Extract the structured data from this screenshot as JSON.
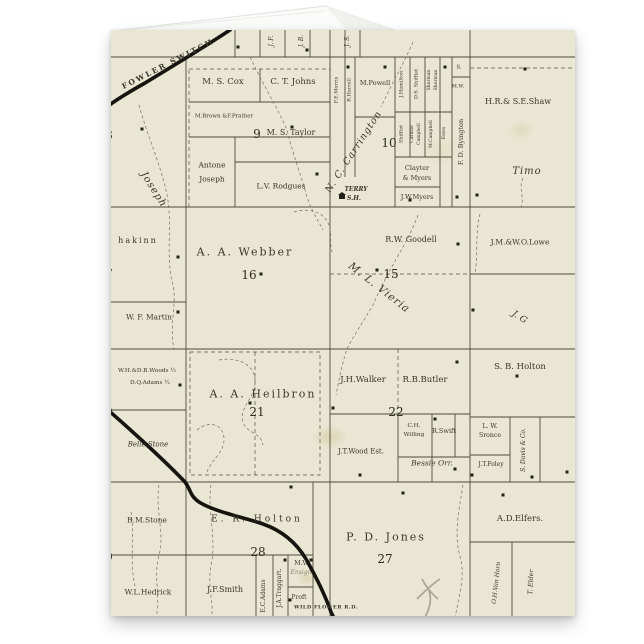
{
  "scene": {
    "background": "#ffffff",
    "paper_color": "#e9e6d3",
    "ink_color": "#3a362c",
    "railroad_color": "#15140f"
  },
  "map": {
    "railroad_label": "FOWLER SWITCH",
    "bottom_road_label": "WILD FLOWER R.D.",
    "school": {
      "line1": "TERRY",
      "line2": "S.H."
    },
    "top_strip": {
      "jf": "J. F.",
      "jb": "J. B.",
      "js": "J. S."
    },
    "section_numbers": {
      "n8": "8",
      "n9": "9",
      "n10": "10",
      "n15": "15",
      "n16": "16",
      "n17": "7",
      "n20": "0",
      "n21": "21",
      "n22": "22",
      "n27": "27",
      "n28": "28",
      "n29": "9"
    },
    "owners": {
      "joseph_diag": "Joseph",
      "cox": "M. S. Cox",
      "johns": "C. T. Johns",
      "brown_prather": "M.Brown &F.Prather",
      "taylor": "M. S. Taylor",
      "antone1": "Antone",
      "antone2": "Joseph",
      "rodgues": "L.V. Rodgues",
      "morris": "F.E.Morris",
      "harrell": "R.Harrell",
      "powell": "M.Powell",
      "hamilton": "J.Hamilton",
      "ds_shifflet": "D.S. Shifflet",
      "sherman1": "Sherman",
      "sherman2": "Sherman",
      "s_small": "S.",
      "mw_small": "M.W.",
      "shifflet": "Shifflet",
      "carlisle": "Carlisle",
      "campbell": "Campbell",
      "mccampbell": "M.Campbell",
      "estes": "Estes",
      "clayter1": "Clayter",
      "clayter2": "& Myers",
      "jw_myers": "J.W.Myers",
      "byington": "F. D. Byington",
      "carrington": "N. C. Carrington",
      "shaw": "H.R.& S.E.Shaw",
      "timo": "Timo",
      "hakinn": "hakinn",
      "martin": "W. F. Martin",
      "webber": "A. A. Webber",
      "goodell": "R.W. Goodell",
      "vieria": "M. L. Vieria",
      "lowe": "J.M.&W.O.Lowe",
      "jg": "J. G",
      "woods": "W.H.&D.B.Woods ½",
      "dq_adams": "D.Q.Adams ½",
      "belle_stone": "Belle Stone",
      "heilbron": "A. A. Heilbron",
      "walker": "J.H.Walker",
      "butler": "R.B.Butler",
      "willing1": "C.H.",
      "willing2": "Willing",
      "swift": "R.Swift",
      "wood_est": "J.T.Wood Est.",
      "bessie_orr": "Bessie Orr.",
      "sb_holton": "S. B. Holton",
      "sronce1": "L. W.",
      "sronce2": "Sronce",
      "davis": "S. Davis & Co.",
      "foley": "J.T.Foley",
      "bm_stone": "B.M.Stone",
      "hedrick": "W.L.Hedrick",
      "er_holton": "E. R. Holton",
      "smith": "J.F.Smith",
      "ec_adams": "E.C.Adams",
      "traggart": "J.A.Traggart.",
      "mv1": "M.V.",
      "mv2": "Ensign",
      "proft": "Proft",
      "jones": "P. D. Jones",
      "elfers": "A.D.Elfers.",
      "van_horn": "O.H.Van Horn",
      "elder": "T. Elder"
    }
  }
}
